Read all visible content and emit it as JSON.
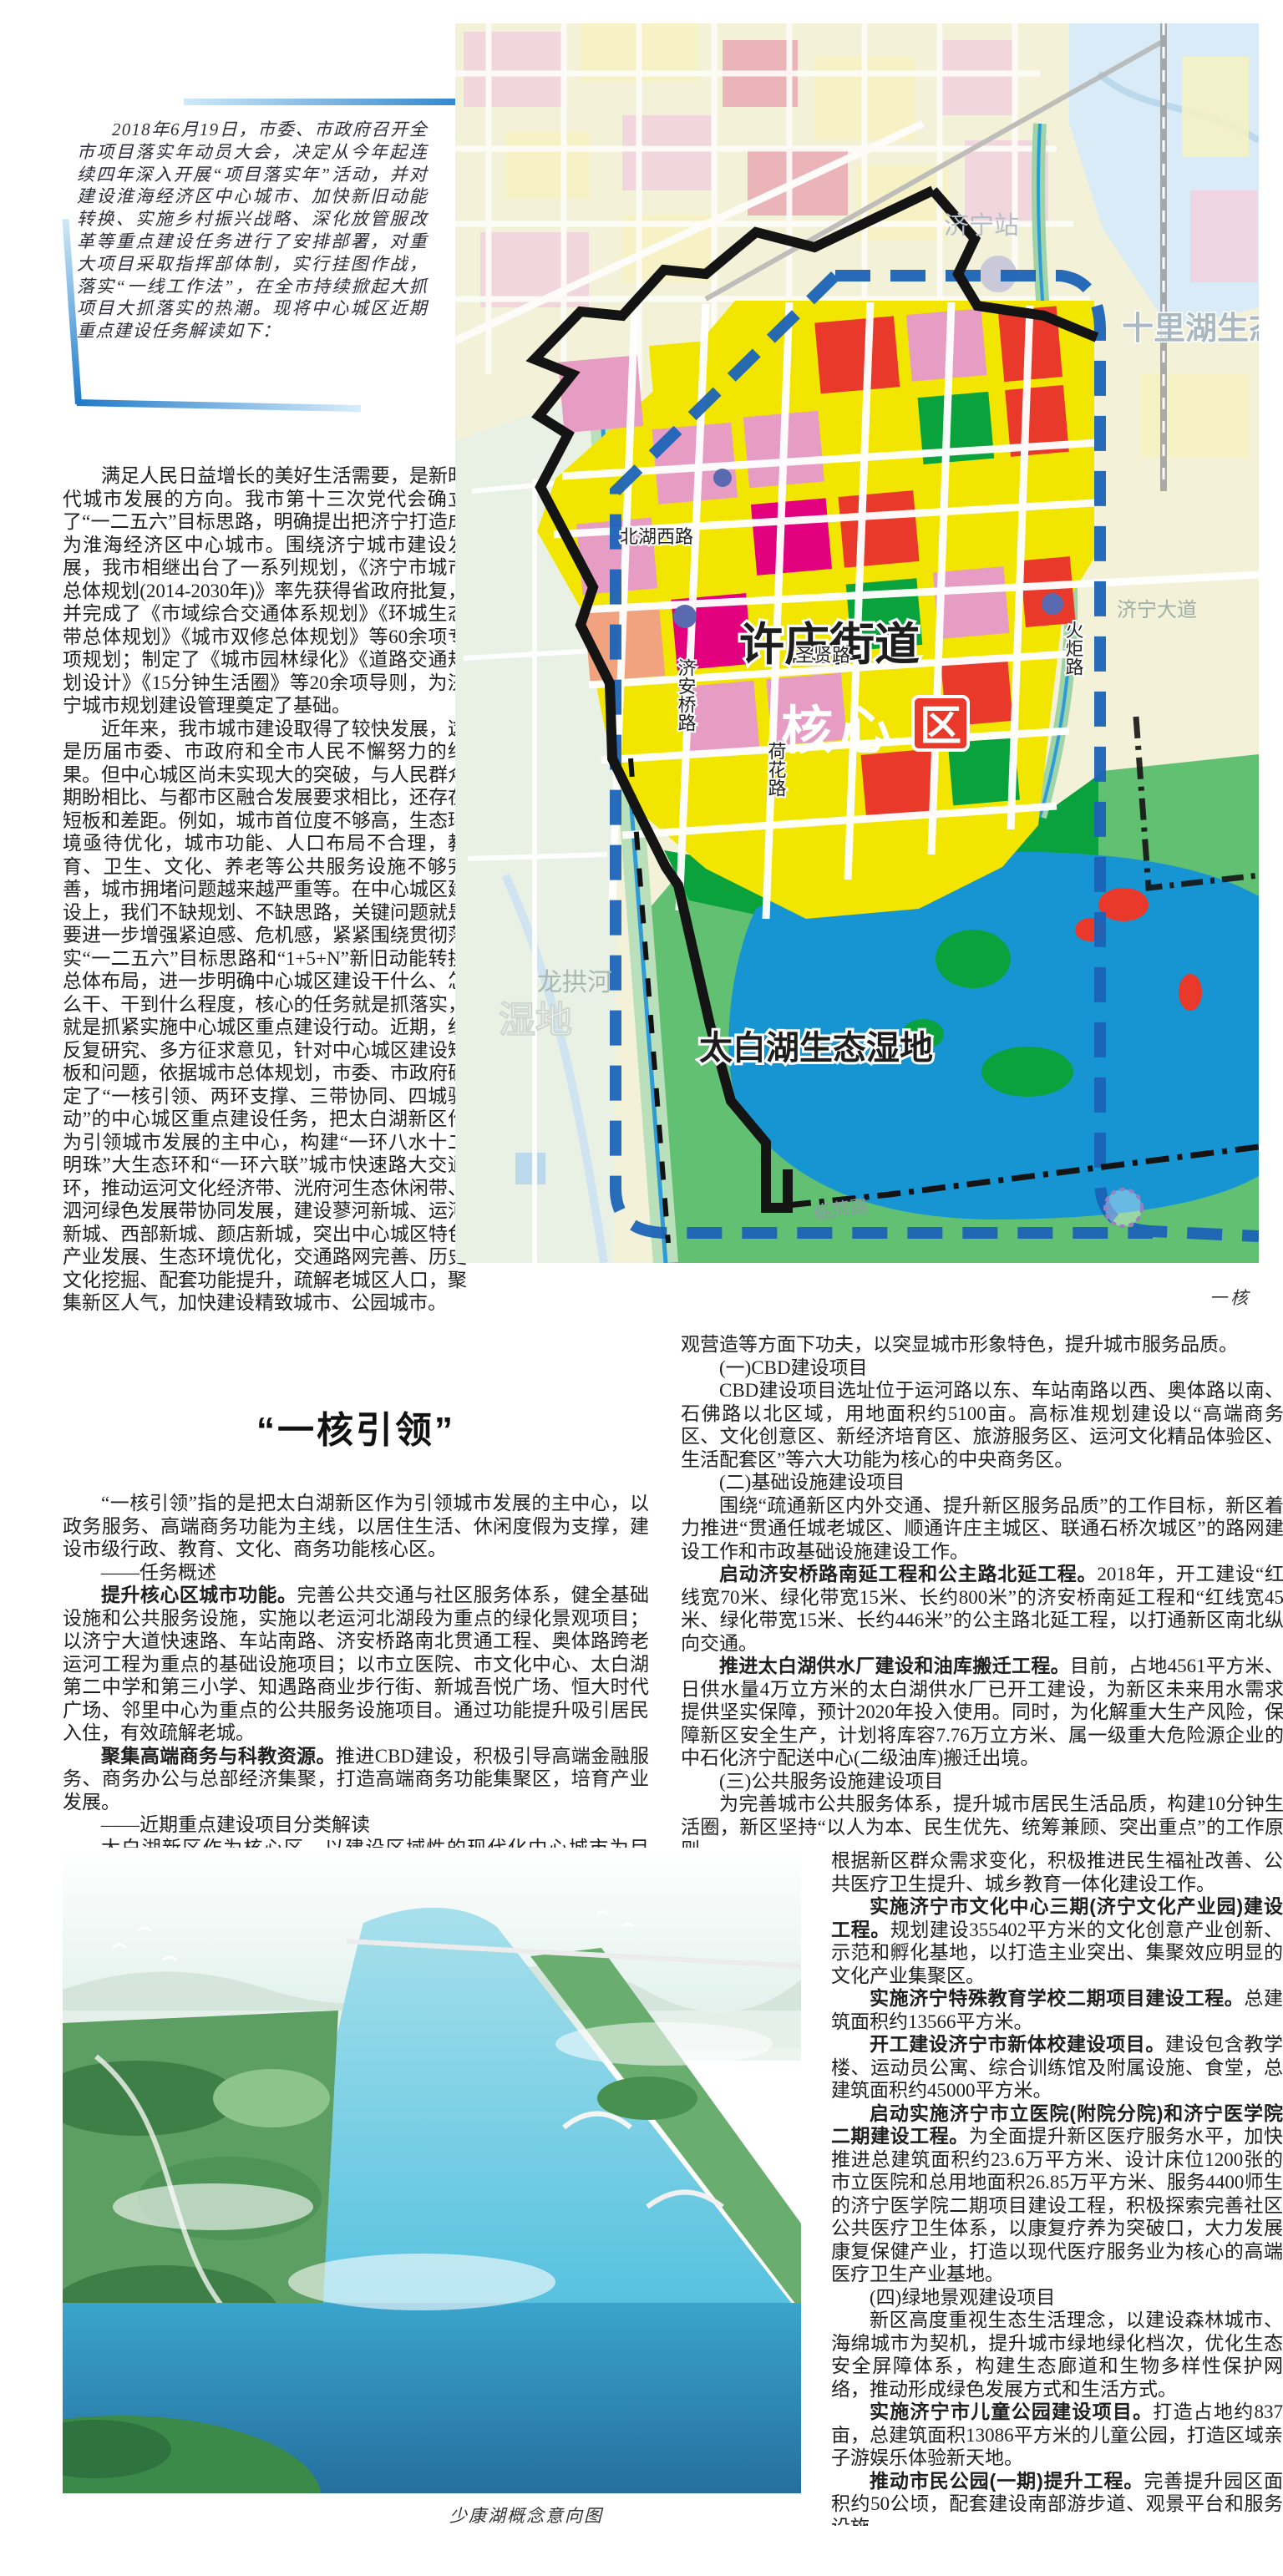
{
  "intro": {
    "text": "2018年6月19日，市委、市政府召开全市项目落实年动员大会，决定从今年起连续四年深入开展“项目落实年”活动，并对建设淮海经济区中心城市、加快新旧动能转换、实施乡村振兴战略、深化放管服改革等重点建设任务进行了安排部署，对重大项目采取指挥部体制，实行挂图作战，落实“一线工作法”，在全市持续掀起大抓项目大抓落实的热潮。现将中心城区近期重点建设任务解读如下："
  },
  "col_a": {
    "p1": "满足人民日益增长的美好生活需要，是新时代城市发展的方向。我市第十三次党代会确立了“一二五六”目标思路，明确提出把济宁打造成为淮海经济区中心城市。围绕济宁城市建设发展，我市相继出台了一系列规划，《济宁市城市总体规划(2014-2030年)》率先获得省政府批复，并完成了《市域综合交通体系规划》《环城生态带总体规划》《城市双修总体规划》等60余项专项规划；制定了《城市园林绿化》《道路交通规划设计》《15分钟生活圈》等20余项导则，为济宁城市规划建设管理奠定了基础。",
    "p2": "近年来，我市城市建设取得了较快发展，这是历届市委、市政府和全市人民不懈努力的结果。但中心城区尚未实现大的突破，与人民群众期盼相比、与都市区融合发展要求相比，还存在短板和差距。例如，城市首位度不够高，生态环境亟待优化，城市功能、人口布局不合理，教育、卫生、文化、养老等公共服务设施不够完善，城市拥堵问题越来越严重等。在中心城区建设上，我们不缺规划、不缺思路，关键问题就是要进一步增强紧迫感、危机感，紧紧围绕贯彻落实“一二五六”目标思路和“1+5+N”新旧动能转换总体布局，进一步明确中心城区建设干什么、怎么干、干到什么程度，核心的任务就是抓落实，就是抓紧实施中心城区重点建设行动。近期，经反复研究、多方征求意见，针对中心城区建设短板和问题，依据城市总体规划，市委、市政府确定了“一核引领、两环支撑、三带协同、四城驱动”的中心城区重点建设任务，把太白湖新区作为引领城市发展的主中心，构建“一环八水十二明珠”大生态环和“一环六联”城市快速路大交通环，推动运河文化经济带、洸府河生态休闲带、泗河绿色发展带协同发展，建设蓼河新城、运河新城、西部新城、颜店新城，突出中心城区特色产业发展、生态环境优化，交通路网完善、历史文化挖掘、配套功能提升，疏解老城区人口，聚集新区人气，加快建设精致城市、公园城市。"
  },
  "heading": {
    "title": "“一核引领”"
  },
  "col_a_wide": {
    "p1": "“一核引领”指的是把太白湖新区作为引领城市发展的主中心，以政务服务、高端商务功能为主线，以居住生活、休闲度假为支撑，建设市级行政、教育、文化、商务功能核心区。",
    "h_task": "——任务概述",
    "p2": {
      "lead": "提升核心区城市功能。",
      "rest": "完善公共交通与社区服务体系，健全基础设施和公共服务设施，实施以老运河北湖段为重点的绿化景观项目；以济宁大道快速路、车站南路、济安桥路南北贯通工程、奥体路跨老运河工程为重点的基础设施项目；以市立医院、市文化中心、太白湖第二中学和第三小学、知遇路商业步行街、新城吾悦广场、恒大时代广场、邻里中心为重点的公共服务设施项目。通过功能提升吸引居民入住，有效疏解老城。"
    },
    "p3": {
      "lead": "聚集高端商务与科教资源。",
      "rest": "推进CBD建设，积极引导高端金融服务、商务办公与总部经济集聚，打造高端商务功能集聚区，培育产业发展。"
    },
    "h_projects": "——近期重点建设项目分类解读",
    "p4": "太白湖新区作为核心区，以建设区域性的现代化中心城市为目标，以市级重点城建项目为抓手，着力在基础设施建设、公服设施配套、绿地景"
  },
  "col_b": {
    "p1": "观营造等方面下功夫，以突显城市形象特色，提升城市服务品质。",
    "h1": "(一)CBD建设项目",
    "p2": "CBD建设项目选址位于运河路以东、车站南路以西、奥体路以南、石佛路以北区域，用地面积约5100亩。高标准规划建设以“高端商务区、文化创意区、新经济培育区、旅游服务区、运河文化精品体验区、生活配套区”等六大功能为核心的中央商务区。",
    "h2": "(二)基础设施建设项目",
    "p3": "围绕“疏通新区内外交通、提升新区服务品质”的工作目标，新区着力推进“贯通任城老城区、顺通许庄主城区、联通石桥次城区”的路网建设工作和市政基础设施建设工作。",
    "p4": {
      "lead": "启动济安桥路南延工程和公主路北延工程。",
      "rest": "2018年，开工建设“红线宽70米、绿化带宽15米、长约800米”的济安桥南延工程和“红线宽45米、绿化带宽15米、长约446米”的公主路北延工程，以打通新区南北纵向交通。"
    },
    "p5": {
      "lead": "推进太白湖供水厂建设和油库搬迁工程。",
      "rest": "目前，占地4561平方米、日供水量4万立方米的太白湖供水厂已开工建设，为新区未来用水需求提供坚实保障，预计2020年投入使用。同时，为化解重大生产风险，保障新区安全生产，计划将库容7.76万立方米、属一级重大危险源企业的中石化济宁配送中心(二级油库)搬迁出境。"
    },
    "h3": "(三)公共服务设施建设项目",
    "p6": "为完善城市公共服务体系，提升城市居民生活品质，构建10分钟生活圈，新区坚持“以人为本、民生优先、统筹兼顾、突出重点”的工作原则，"
  },
  "col_c": {
    "p1": "根据新区群众需求变化，积极推进民生福祉改善、公共医疗卫生提升、城乡教育一体化建设工作。",
    "p2": {
      "lead": "实施济宁市文化中心三期(济宁文化产业园)建设工程。",
      "rest": "规划建设355402平方米的文化创意产业创新、示范和孵化基地，以打造主业突出、集聚效应明显的文化产业集聚区。"
    },
    "p3": {
      "lead": "实施济宁特殊教育学校二期项目建设工程。",
      "rest": "总建筑面积约13566平方米。"
    },
    "p4": {
      "lead": "开工建设济宁市新体校建设项目。",
      "rest": "建设包含教学楼、运动员公寓、综合训练馆及附属设施、食堂，总建筑面积约45000平方米。"
    },
    "p5": {
      "lead": "启动实施济宁市立医院(附院分院)和济宁医学院二期建设工程。",
      "rest": "为全面提升新区医疗服务水平，加快推进总建筑面积约23.6万平方米、设计床位1200张的市立医院和总用地面积26.85万平方米、服务4400师生的济宁医学院二期项目建设工程，积极探索完善社区公共医疗卫生体系，以康复疗养为突破口，大力发展康复保健产业，打造以现代医疗服务业为核心的高端医疗卫生产业基地。"
    },
    "h4": "(四)绿地景观建设项目",
    "p6": "新区高度重视生态生活理念，以建设森林城市、海绵城市为契机，提升城市绿地绿化档次，优化生态安全屏障体系，构建生态廊道和生物多样性保护网络，推动形成绿色发展方式和生活方式。",
    "p7": {
      "lead": "实施济宁市儿童公园建设项目。",
      "rest": "打造占地约837亩，总建筑面积13086平方米的儿童公园，打造区域亲子游娱乐体验新天地。"
    },
    "p8": {
      "lead": "推动市民公园(一期)提升工程。",
      "rest": "完善提升园区面积约50公顷，配套建设南部游步道、观景平台和服务设施。"
    }
  },
  "map": {
    "labels": {
      "xuzhuang": "许庄街道",
      "hexin": "核心",
      "qu": "区",
      "taibaihu": "太白湖生态湿地",
      "longgonghe": "龙拱河",
      "jiningdadao": "济宁大道",
      "beihuxilu": "北湖西路",
      "shengxianlu": "圣贤路",
      "jianqiaolu": "济安桥路",
      "hehualu": "荷花路",
      "huojulu": "火炬路",
      "linhelu": "临菏路",
      "shilihu": "十里湖生态",
      "jiningzhan": "济宁站",
      "shidi": "湿地"
    },
    "colors": {
      "residential_yellow": "#f2e600",
      "pink": "#e79dc3",
      "magenta": "#e2007e",
      "red": "#e8392b",
      "park_green": "#0aa23c",
      "light_green": "#62c073",
      "lake_blue": "#1795d3",
      "ring_blue": "#1c63b7",
      "frame_blue": "#1f7ac9",
      "boundary_black": "#141414"
    }
  },
  "captions": {
    "map_caption": "一核",
    "photo_caption": "少康湖概念意向图"
  }
}
